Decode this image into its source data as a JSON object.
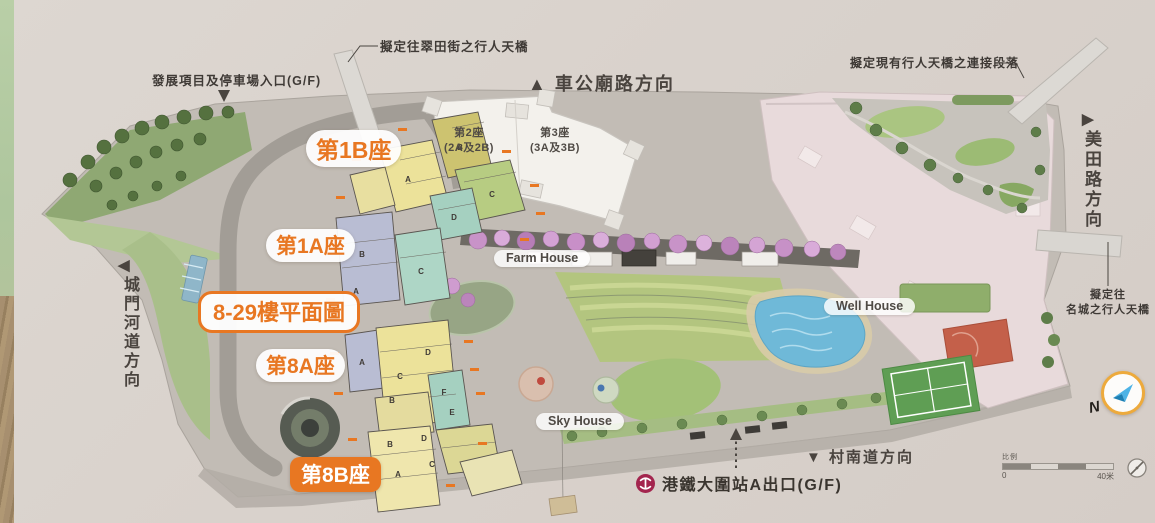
{
  "colors": {
    "accent_orange": "#E87722",
    "mtr_red": "#A3254E",
    "compass_ring": "#EDAA3C",
    "compass_blue": "#2E9BD6"
  },
  "arrows": {
    "up": "▲",
    "down": "▼",
    "left": "◀",
    "right": "▶"
  },
  "notes": {
    "bridge_tsui_tin": "擬定往翠田街之行人天橋",
    "che_kung": "車公廟路方向",
    "dev_entrance": "發展項目及停車場入口(G/F)",
    "existing_bridge": "擬定現有行人天橋之連接段落",
    "mei_tin": "美田路方向",
    "festival_1": "擬定往",
    "festival_2": "名城之行人天橋",
    "shing_mun": "城門河道方向",
    "mtr_exit": "港鐵大圍站A出口(G/F)",
    "tsuen_nam": "村南道方向"
  },
  "plan_labels": {
    "t1b": "第1B座",
    "t1a": "第1A座",
    "range": "8-29樓平面圖",
    "t8a": "第8A座",
    "t8b": "第8B座"
  },
  "towers": {
    "t2": {
      "line1": "第2座",
      "line2": "(2A及2B)"
    },
    "t3": {
      "line1": "第3座",
      "line2": "(3A及3B)"
    }
  },
  "houses": {
    "farm": "Farm House",
    "well": "Well House",
    "sky": "Sky House"
  },
  "compass": {
    "n": "N"
  },
  "scale": {
    "label": "比例",
    "zero": "0",
    "max": "40米"
  },
  "units": {
    "t1b": [
      "A",
      "B",
      "C",
      "D"
    ],
    "t1a": [
      "B",
      "A",
      "C"
    ],
    "t8a": [
      "A",
      "D",
      "C",
      "B",
      "F",
      "E"
    ],
    "t8b": [
      "B",
      "D",
      "A",
      "C"
    ]
  }
}
